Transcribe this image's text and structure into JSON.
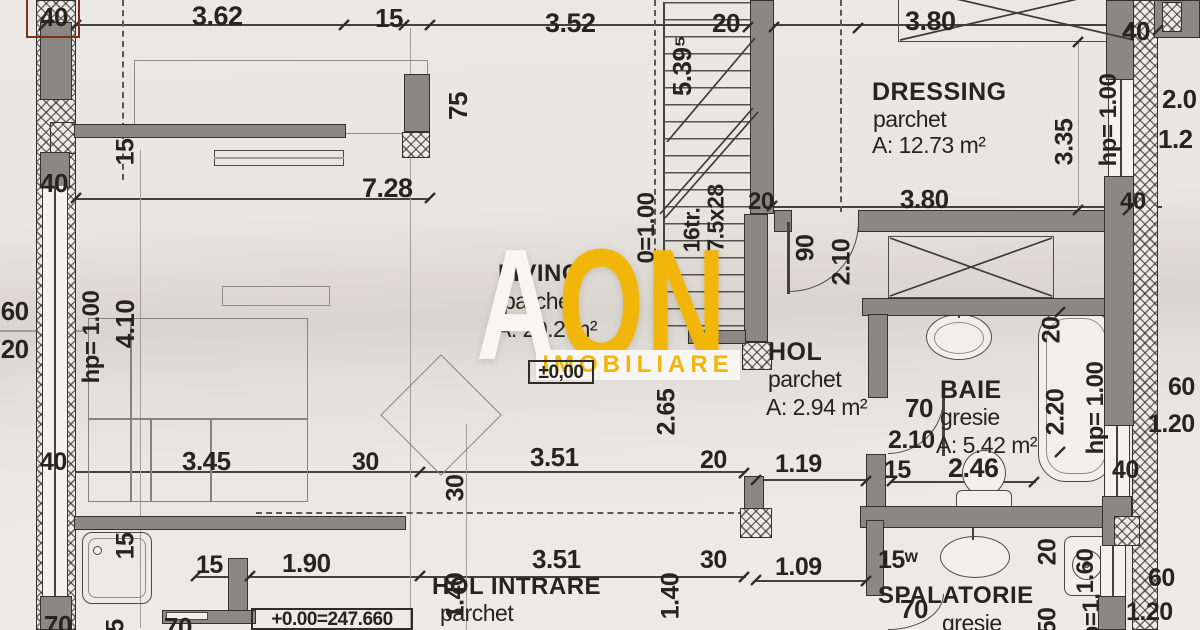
{
  "watermark": {
    "letter_a": "A",
    "letters_on": "ON",
    "subtitle": "IMOBILIARE",
    "yellow": "#f2b60b",
    "white": "#f8f6f2"
  },
  "colors": {
    "paper": "#e9e7e3",
    "wall_fill": "#8b8883",
    "line": "#34322e",
    "red_annotation": "#7b3020"
  },
  "rooms": {
    "living": {
      "name": "LIVING",
      "floor": "parchet",
      "area": "A: 20.2 m²",
      "elevation": "±0,00"
    },
    "dressing": {
      "name": "DRESSING",
      "floor": "parchet",
      "area": "A: 12.73 m²"
    },
    "hol": {
      "name": "HOL",
      "floor": "parchet",
      "area": "A: 2.94 m²"
    },
    "baie": {
      "name": "BAIE",
      "floor": "gresie",
      "area": "A: 5.42 m²"
    },
    "hol_intrare": {
      "name": "HOL INTRARE",
      "floor": "parchet",
      "elevation": "+0.00=247.660"
    },
    "spalatorie": {
      "name": "SPALATORIE",
      "floor": "gresie"
    }
  },
  "stair": {
    "treads": "16tr.",
    "step": "7.5x28",
    "width": "0=1.00"
  },
  "labels": {
    "top_40_l": "40",
    "top_362": "3.62",
    "top_15": "15",
    "top_352": "3.52",
    "top_20": "20",
    "top_380": "3.80",
    "top_40_r": "40",
    "mid_40_l": "40",
    "mid_728": "7.28",
    "mid_20": "20",
    "mid_380": "3.80",
    "mid_40_r": "40",
    "v_15_l": "15",
    "v_75": "75",
    "v_5395": "5.39⁵",
    "left_60": ".60",
    "left_20": ".20",
    "left_hp": "hp= 1.00",
    "left_410": "4.10",
    "door_90": "90",
    "door_210": "2.10",
    "right_20": "2.0",
    "right_12": "1.2",
    "v_335": "3.35",
    "right_hp1": "hp= 1.00",
    "v_20_baie": "20",
    "v_220": "2.20",
    "right_hp2": "hp= 1.00",
    "baie_70": "70",
    "baie_210": "2.10",
    "baie_15": "15",
    "baie_246": "2.46",
    "win_60_a": "60",
    "win_120_a": "1.20",
    "right_40_a": "40",
    "win_60_b": "60",
    "win_120_b": "1.20",
    "low_40": "40",
    "low_345": "3.45",
    "low_30": "30",
    "v_15_shower": "15",
    "low_15": "15",
    "low_190": "1.90",
    "low_70_a": "70",
    "low_70_b": "70",
    "hi_351_a": "3.51",
    "hi_20": "20",
    "hi_351_b": "3.51",
    "hi_30": "30",
    "v_30": "30",
    "v_140_a": "1.40",
    "v_140_b": "1.40",
    "v_265": "2.65",
    "sp_119": "1.19",
    "sp_15_a": "15",
    "sp_109": "1.09",
    "sp_15_w": "15ʷ",
    "sp_70": "70",
    "v_20_sp": "20",
    "v_50_sp": "50",
    "v_160": "1.60",
    "hp_cut": "hp=1.",
    "v_5_cut": "5"
  }
}
